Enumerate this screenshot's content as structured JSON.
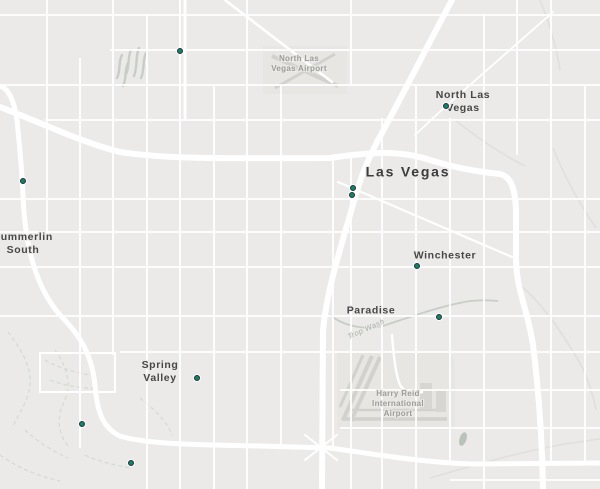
{
  "map": {
    "colors": {
      "background": "#ebeae8",
      "road_white": "#ffffff",
      "road_minor_gray": "#e0dfdc",
      "wash_line": "#c7cec6",
      "trail_dashed": "#d4d9d3",
      "airport_fill": "#e7e6e2",
      "runway": "#d2d1cd",
      "water_blob": "#b9c3b9",
      "marker_fill": "#0e8468",
      "marker_ring": "#243038",
      "label_major": "#3c3c3c",
      "label_city": "#474747",
      "label_airport": "#9c9c98",
      "label_wash": "#a8b0a6"
    },
    "labels": [
      {
        "id": "north-las-vegas-airport",
        "text": "North Las\nVegas Airport",
        "x": 299,
        "y": 64
      },
      {
        "id": "north-las-vegas",
        "text": "North Las\nVegas",
        "x": 463,
        "y": 102
      },
      {
        "id": "las-vegas",
        "text": "Las Vegas",
        "x": 408,
        "y": 172
      },
      {
        "id": "summerlin-south",
        "text": "Summerlin\nSouth",
        "x": 23,
        "y": 244
      },
      {
        "id": "winchester",
        "text": "Winchester",
        "x": 445,
        "y": 256
      },
      {
        "id": "paradise",
        "text": "Paradise",
        "x": 371,
        "y": 311
      },
      {
        "id": "trop-wash",
        "text": "Trop Wash",
        "x": 366,
        "y": 329,
        "rotate": -24
      },
      {
        "id": "spring-valley",
        "text": "Spring\nValley",
        "x": 160,
        "y": 372
      },
      {
        "id": "harry-reid-airport",
        "text": "Harry Reid\nInternational\nAirport",
        "x": 398,
        "y": 404
      }
    ],
    "markers": [
      {
        "x": 180,
        "y": 51
      },
      {
        "x": 23,
        "y": 181
      },
      {
        "x": 446,
        "y": 106
      },
      {
        "x": 353,
        "y": 188
      },
      {
        "x": 352,
        "y": 195
      },
      {
        "x": 417,
        "y": 266
      },
      {
        "x": 439,
        "y": 317
      },
      {
        "x": 197,
        "y": 378
      },
      {
        "x": 82,
        "y": 424
      },
      {
        "x": 131,
        "y": 463
      }
    ]
  }
}
